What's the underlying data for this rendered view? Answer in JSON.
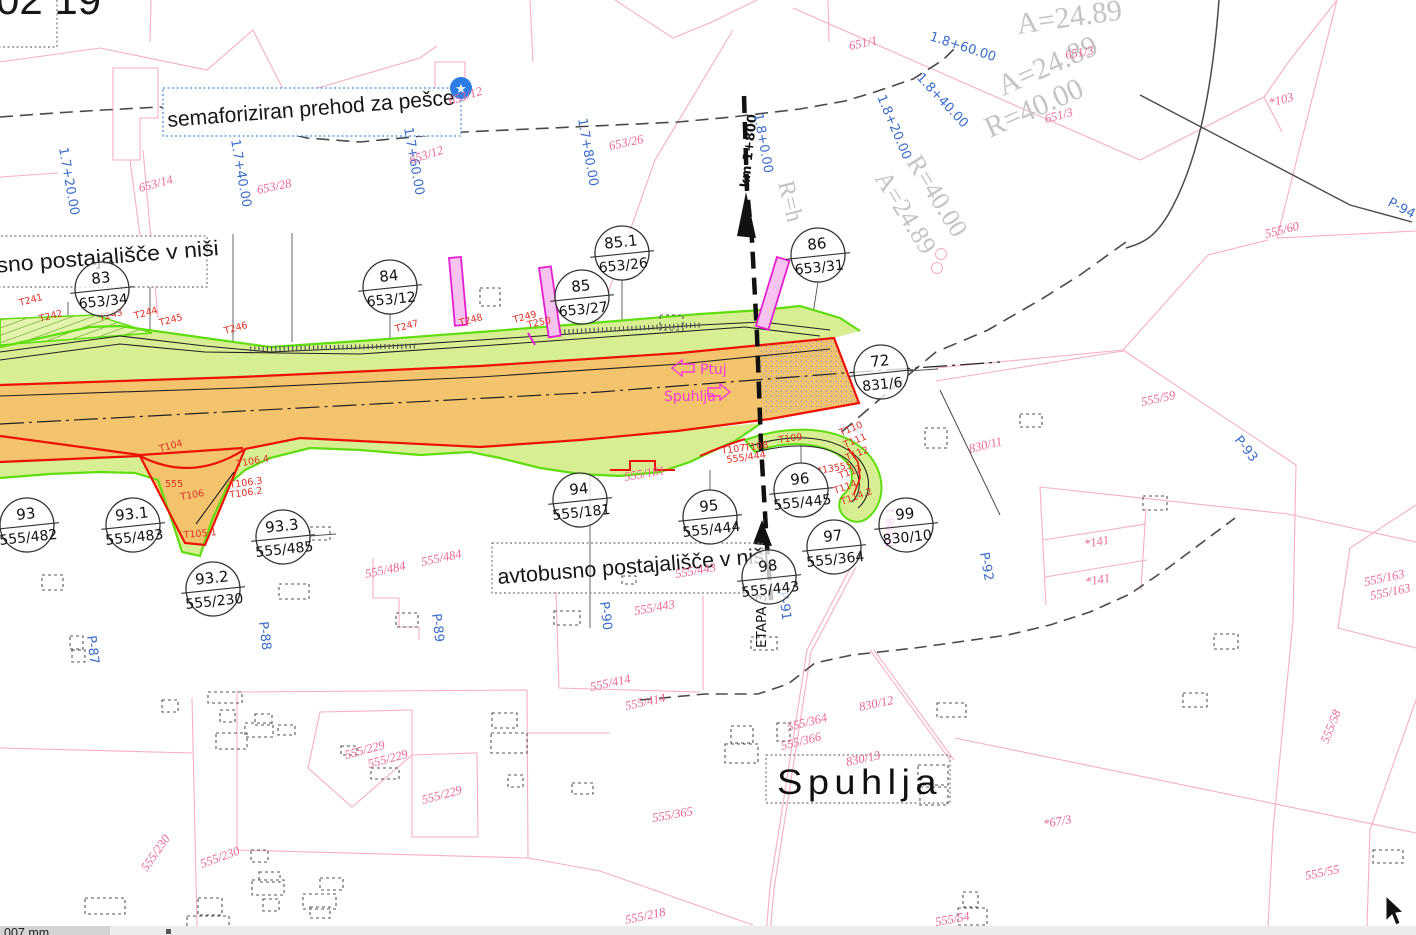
{
  "canvas": {
    "width": 1416,
    "height": 935
  },
  "colors": {
    "carriageway_orange": "#f3c46d",
    "verge_green_fill": "#d7ef92",
    "verge_green_stroke": "#5fdd0e",
    "road_edge_red": "#ee1106",
    "parcel_line_pink": "#f6aec6",
    "parcel_label_pink": "#ee6695",
    "station_blue": "#3a6ccc",
    "geometry_gray": "#c4c4c4",
    "magenta": "#f23bd8",
    "shelter_magenta": "#e41fd0",
    "annotation_black": "#161616",
    "star_badge_blue": "#2d7be5"
  },
  "annotations": {
    "corner_fragment": "02 19",
    "crossing_note": "semaforiziran prehod za pešce",
    "bus_stop_note_top": "avtobusno postajališče v niši",
    "bus_stop_note_bottom": "avtobusno postajališče v niši",
    "place_name": "Spuhlja",
    "stage_label": "ETAPA 3",
    "km_label": "km 1+800",
    "direction_left": "Ptuj",
    "direction_right": "Spuhlja"
  },
  "status_bar": {
    "left_text": "007 mm"
  },
  "parcel_circles": [
    {
      "num": "83",
      "parcel": "653/34",
      "x": 102,
      "y": 289
    },
    {
      "num": "84",
      "parcel": "653/12",
      "x": 390,
      "y": 287
    },
    {
      "num": "85",
      "parcel": "653/27",
      "x": 582,
      "y": 297
    },
    {
      "num": "85.1",
      "parcel": "653/26",
      "x": 622,
      "y": 253
    },
    {
      "num": "86",
      "parcel": "653/31",
      "x": 818,
      "y": 255
    },
    {
      "num": "72",
      "parcel": "831/6",
      "x": 881,
      "y": 372
    },
    {
      "num": "93",
      "parcel": "555/482",
      "x": 27,
      "y": 525
    },
    {
      "num": "93.1",
      "parcel": "555/483",
      "x": 133,
      "y": 525
    },
    {
      "num": "93.2",
      "parcel": "555/230",
      "x": 213,
      "y": 589
    },
    {
      "num": "93.3",
      "parcel": "555/485",
      "x": 283,
      "y": 537
    },
    {
      "num": "94",
      "parcel": "555/181",
      "x": 580,
      "y": 500
    },
    {
      "num": "95",
      "parcel": "555/444",
      "x": 710,
      "y": 517
    },
    {
      "num": "96",
      "parcel": "555/445",
      "x": 801,
      "y": 490
    },
    {
      "num": "97",
      "parcel": "555/364",
      "x": 834,
      "y": 547
    },
    {
      "num": "98",
      "parcel": "555/443",
      "x": 769,
      "y": 577
    },
    {
      "num": "99",
      "parcel": "830/10",
      "x": 906,
      "y": 525
    }
  ],
  "station_labels": [
    {
      "t": "1.7+20.00",
      "x": 59,
      "y": 148,
      "r": 80
    },
    {
      "t": "1.7+40.00",
      "x": 231,
      "y": 140,
      "r": 80
    },
    {
      "t": "1.7+60.00",
      "x": 404,
      "y": 128,
      "r": 80
    },
    {
      "t": "1.7+80.00",
      "x": 578,
      "y": 119,
      "r": 80
    },
    {
      "t": "1.8+0.00",
      "x": 754,
      "y": 114,
      "r": 80
    },
    {
      "t": "1.8+20.00",
      "x": 877,
      "y": 97,
      "r": 67
    },
    {
      "t": "1.8+40.00",
      "x": 916,
      "y": 78,
      "r": 47
    },
    {
      "t": "1.8+60.00",
      "x": 929,
      "y": 40,
      "r": 18
    }
  ],
  "profile_labels": [
    {
      "t": "P-87",
      "x": 87,
      "y": 636,
      "r": 83
    },
    {
      "t": "P-88",
      "x": 259,
      "y": 622,
      "r": 83
    },
    {
      "t": "P-89",
      "x": 432,
      "y": 614,
      "r": 83
    },
    {
      "t": "P-90",
      "x": 600,
      "y": 602,
      "r": 83
    },
    {
      "t": "P-91",
      "x": 779,
      "y": 592,
      "r": 83
    },
    {
      "t": "P-92",
      "x": 980,
      "y": 553,
      "r": 80
    },
    {
      "t": "P-93",
      "x": 1234,
      "y": 440,
      "r": 52
    },
    {
      "t": "P-94",
      "x": 1387,
      "y": 205,
      "r": 28
    }
  ],
  "geometry_labels": [
    {
      "t": "A=24.89",
      "x": 1018,
      "y": 34,
      "r": -8,
      "s": 30
    },
    {
      "t": "A=24.89",
      "x": 1003,
      "y": 96,
      "r": -24,
      "s": 30
    },
    {
      "t": "R=40.00",
      "x": 990,
      "y": 138,
      "r": -24,
      "s": 30
    },
    {
      "t": "R=40.00",
      "x": 906,
      "y": 162,
      "r": 58,
      "s": 26
    },
    {
      "t": "A=24.89",
      "x": 874,
      "y": 178,
      "r": 58,
      "s": 26
    },
    {
      "t": "R=h",
      "x": 778,
      "y": 183,
      "r": 76,
      "s": 24
    }
  ],
  "parcel_labels": [
    {
      "t": "651/1",
      "x": 850,
      "y": 50,
      "r": -12
    },
    {
      "t": "651/3",
      "x": 1066,
      "y": 59,
      "r": -10
    },
    {
      "t": "651/3",
      "x": 1046,
      "y": 123,
      "r": -15
    },
    {
      "t": "*103",
      "x": 1270,
      "y": 107,
      "r": -15
    },
    {
      "t": "653/12",
      "x": 450,
      "y": 105,
      "r": -18
    },
    {
      "t": "653/12",
      "x": 411,
      "y": 164,
      "r": -18
    },
    {
      "t": "653/14",
      "x": 140,
      "y": 192,
      "r": -15
    },
    {
      "t": "653/28",
      "x": 258,
      "y": 194,
      "r": -12
    },
    {
      "t": "653/26",
      "x": 610,
      "y": 150,
      "r": -12
    },
    {
      "t": "555/60",
      "x": 1266,
      "y": 238,
      "r": -14
    },
    {
      "t": "555/59",
      "x": 1142,
      "y": 406,
      "r": -12
    },
    {
      "t": "830/11",
      "x": 970,
      "y": 453,
      "r": -14
    },
    {
      "t": "555/484",
      "x": 366,
      "y": 578,
      "r": -12
    },
    {
      "t": "555/484",
      "x": 422,
      "y": 566,
      "r": -12
    },
    {
      "t": "555/181",
      "x": 625,
      "y": 481,
      "r": -10
    },
    {
      "t": "555/443",
      "x": 676,
      "y": 578,
      "r": -10
    },
    {
      "t": "555/443",
      "x": 635,
      "y": 615,
      "r": -10
    },
    {
      "t": "555/414",
      "x": 591,
      "y": 691,
      "r": -12
    },
    {
      "t": "555/414",
      "x": 626,
      "y": 710,
      "r": -12
    },
    {
      "t": "555/364",
      "x": 788,
      "y": 731,
      "r": -14
    },
    {
      "t": "555/366",
      "x": 782,
      "y": 750,
      "r": -14
    },
    {
      "t": "830/12",
      "x": 860,
      "y": 711,
      "r": -12
    },
    {
      "t": "830/13",
      "x": 847,
      "y": 766,
      "r": -12
    },
    {
      "t": "*67/3",
      "x": 1044,
      "y": 828,
      "r": -10
    },
    {
      "t": "555/58",
      "x": 1328,
      "y": 744,
      "r": -68
    },
    {
      "t": "555/163",
      "x": 1365,
      "y": 586,
      "r": -12
    },
    {
      "t": "555/163",
      "x": 1371,
      "y": 600,
      "r": -12
    },
    {
      "t": "*141",
      "x": 1085,
      "y": 548,
      "r": -10
    },
    {
      "t": "*141",
      "x": 1086,
      "y": 586,
      "r": -10
    },
    {
      "t": "555/229",
      "x": 346,
      "y": 759,
      "r": -15
    },
    {
      "t": "555/229",
      "x": 369,
      "y": 768,
      "r": -15
    },
    {
      "t": "555/229",
      "x": 423,
      "y": 804,
      "r": -15
    },
    {
      "t": "555/230",
      "x": 147,
      "y": 872,
      "r": -55
    },
    {
      "t": "555/230",
      "x": 202,
      "y": 868,
      "r": -20
    },
    {
      "t": "555/218",
      "x": 626,
      "y": 924,
      "r": -12
    },
    {
      "t": "555/55",
      "x": 1306,
      "y": 880,
      "r": -12
    },
    {
      "t": "555/54",
      "x": 936,
      "y": 926,
      "r": -10
    },
    {
      "t": "555/365",
      "x": 653,
      "y": 822,
      "r": -10
    }
  ],
  "survey_point_labels": [
    {
      "t": "T241",
      "x": 20,
      "y": 306,
      "r": -15
    },
    {
      "t": "T242",
      "x": 40,
      "y": 322,
      "r": -15
    },
    {
      "t": "T243",
      "x": 100,
      "y": 321,
      "r": -15
    },
    {
      "t": "T244",
      "x": 135,
      "y": 319,
      "r": -15
    },
    {
      "t": "T245",
      "x": 160,
      "y": 326,
      "r": -15
    },
    {
      "t": "T246",
      "x": 225,
      "y": 334,
      "r": -15
    },
    {
      "t": "T247",
      "x": 396,
      "y": 332,
      "r": -15
    },
    {
      "t": "T248",
      "x": 460,
      "y": 326,
      "r": -15
    },
    {
      "t": "T249",
      "x": 514,
      "y": 323,
      "r": -15
    },
    {
      "t": "T250",
      "x": 528,
      "y": 328,
      "r": -12
    },
    {
      "t": "T104",
      "x": 160,
      "y": 452,
      "r": -15
    },
    {
      "t": "555",
      "x": 165,
      "y": 487,
      "r": 0
    },
    {
      "t": "T106",
      "x": 181,
      "y": 500,
      "r": -10
    },
    {
      "t": "T105.1",
      "x": 184,
      "y": 538,
      "r": -5
    },
    {
      "t": "T106.4",
      "x": 237,
      "y": 467,
      "r": -10
    },
    {
      "t": "T106.3",
      "x": 230,
      "y": 488,
      "r": -8
    },
    {
      "t": "T106.2",
      "x": 230,
      "y": 498,
      "r": -8
    },
    {
      "t": "T107",
      "x": 722,
      "y": 454,
      "r": -8
    },
    {
      "t": "T108",
      "x": 745,
      "y": 451,
      "r": -8
    },
    {
      "t": "T109",
      "x": 779,
      "y": 443,
      "r": -8
    },
    {
      "t": "T110",
      "x": 841,
      "y": 436,
      "r": -22
    },
    {
      "t": "T111",
      "x": 845,
      "y": 448,
      "r": -22
    },
    {
      "t": "T112",
      "x": 847,
      "y": 461,
      "r": -22
    },
    {
      "t": "T113",
      "x": 840,
      "y": 479,
      "r": -20
    },
    {
      "t": "*13555",
      "x": 818,
      "y": 474,
      "r": -10
    },
    {
      "t": "T114",
      "x": 835,
      "y": 494,
      "r": -20
    },
    {
      "t": "T114.2",
      "x": 842,
      "y": 505,
      "r": -20
    },
    {
      "t": "555/444",
      "x": 727,
      "y": 463,
      "r": -8
    }
  ],
  "magenta_labels": [
    {
      "t": "M308-1",
      "x": 894,
      "y": 547,
      "r": -90
    }
  ],
  "buildings": [
    [
      480,
      288,
      20,
      18
    ],
    [
      660,
      315,
      23,
      15
    ],
    [
      925,
      428,
      22,
      20
    ],
    [
      1020,
      414,
      22,
      13
    ],
    [
      42,
      575,
      21,
      15
    ],
    [
      279,
      584,
      30,
      15
    ],
    [
      310,
      527,
      20,
      13
    ],
    [
      396,
      613,
      22,
      14
    ],
    [
      70,
      636,
      13,
      13
    ],
    [
      72,
      650,
      13,
      12
    ],
    [
      554,
      611,
      26,
      14
    ],
    [
      751,
      637,
      26,
      13
    ],
    [
      622,
      576,
      14,
      8
    ],
    [
      937,
      703,
      29,
      14
    ],
    [
      731,
      726,
      22,
      17
    ],
    [
      725,
      744,
      33,
      19
    ],
    [
      777,
      723,
      13,
      18
    ],
    [
      918,
      765,
      30,
      20
    ],
    [
      920,
      787,
      28,
      18
    ],
    [
      1143,
      496,
      24,
      14
    ],
    [
      1214,
      634,
      24,
      15
    ],
    [
      1183,
      693,
      24,
      14
    ],
    [
      162,
      700,
      16,
      12
    ],
    [
      208,
      692,
      34,
      11
    ],
    [
      220,
      710,
      15,
      12
    ],
    [
      255,
      714,
      17,
      11
    ],
    [
      245,
      723,
      28,
      14
    ],
    [
      278,
      725,
      17,
      10
    ],
    [
      216,
      733,
      31,
      16
    ],
    [
      341,
      746,
      16,
      9
    ],
    [
      371,
      768,
      28,
      11
    ],
    [
      492,
      713,
      25,
      15
    ],
    [
      491,
      733,
      36,
      20
    ],
    [
      508,
      775,
      15,
      12
    ],
    [
      572,
      783,
      21,
      11
    ],
    [
      251,
      850,
      17,
      12
    ],
    [
      259,
      872,
      21,
      10
    ],
    [
      252,
      880,
      32,
      15
    ],
    [
      263,
      899,
      16,
      12
    ],
    [
      303,
      894,
      33,
      15
    ],
    [
      320,
      878,
      23,
      12
    ],
    [
      310,
      907,
      20,
      11
    ],
    [
      198,
      898,
      24,
      17
    ],
    [
      187,
      916,
      42,
      14
    ],
    [
      85,
      898,
      40,
      16
    ],
    [
      1373,
      850,
      30,
      13
    ],
    [
      963,
      892,
      15,
      15
    ],
    [
      958,
      908,
      29,
      17
    ]
  ]
}
